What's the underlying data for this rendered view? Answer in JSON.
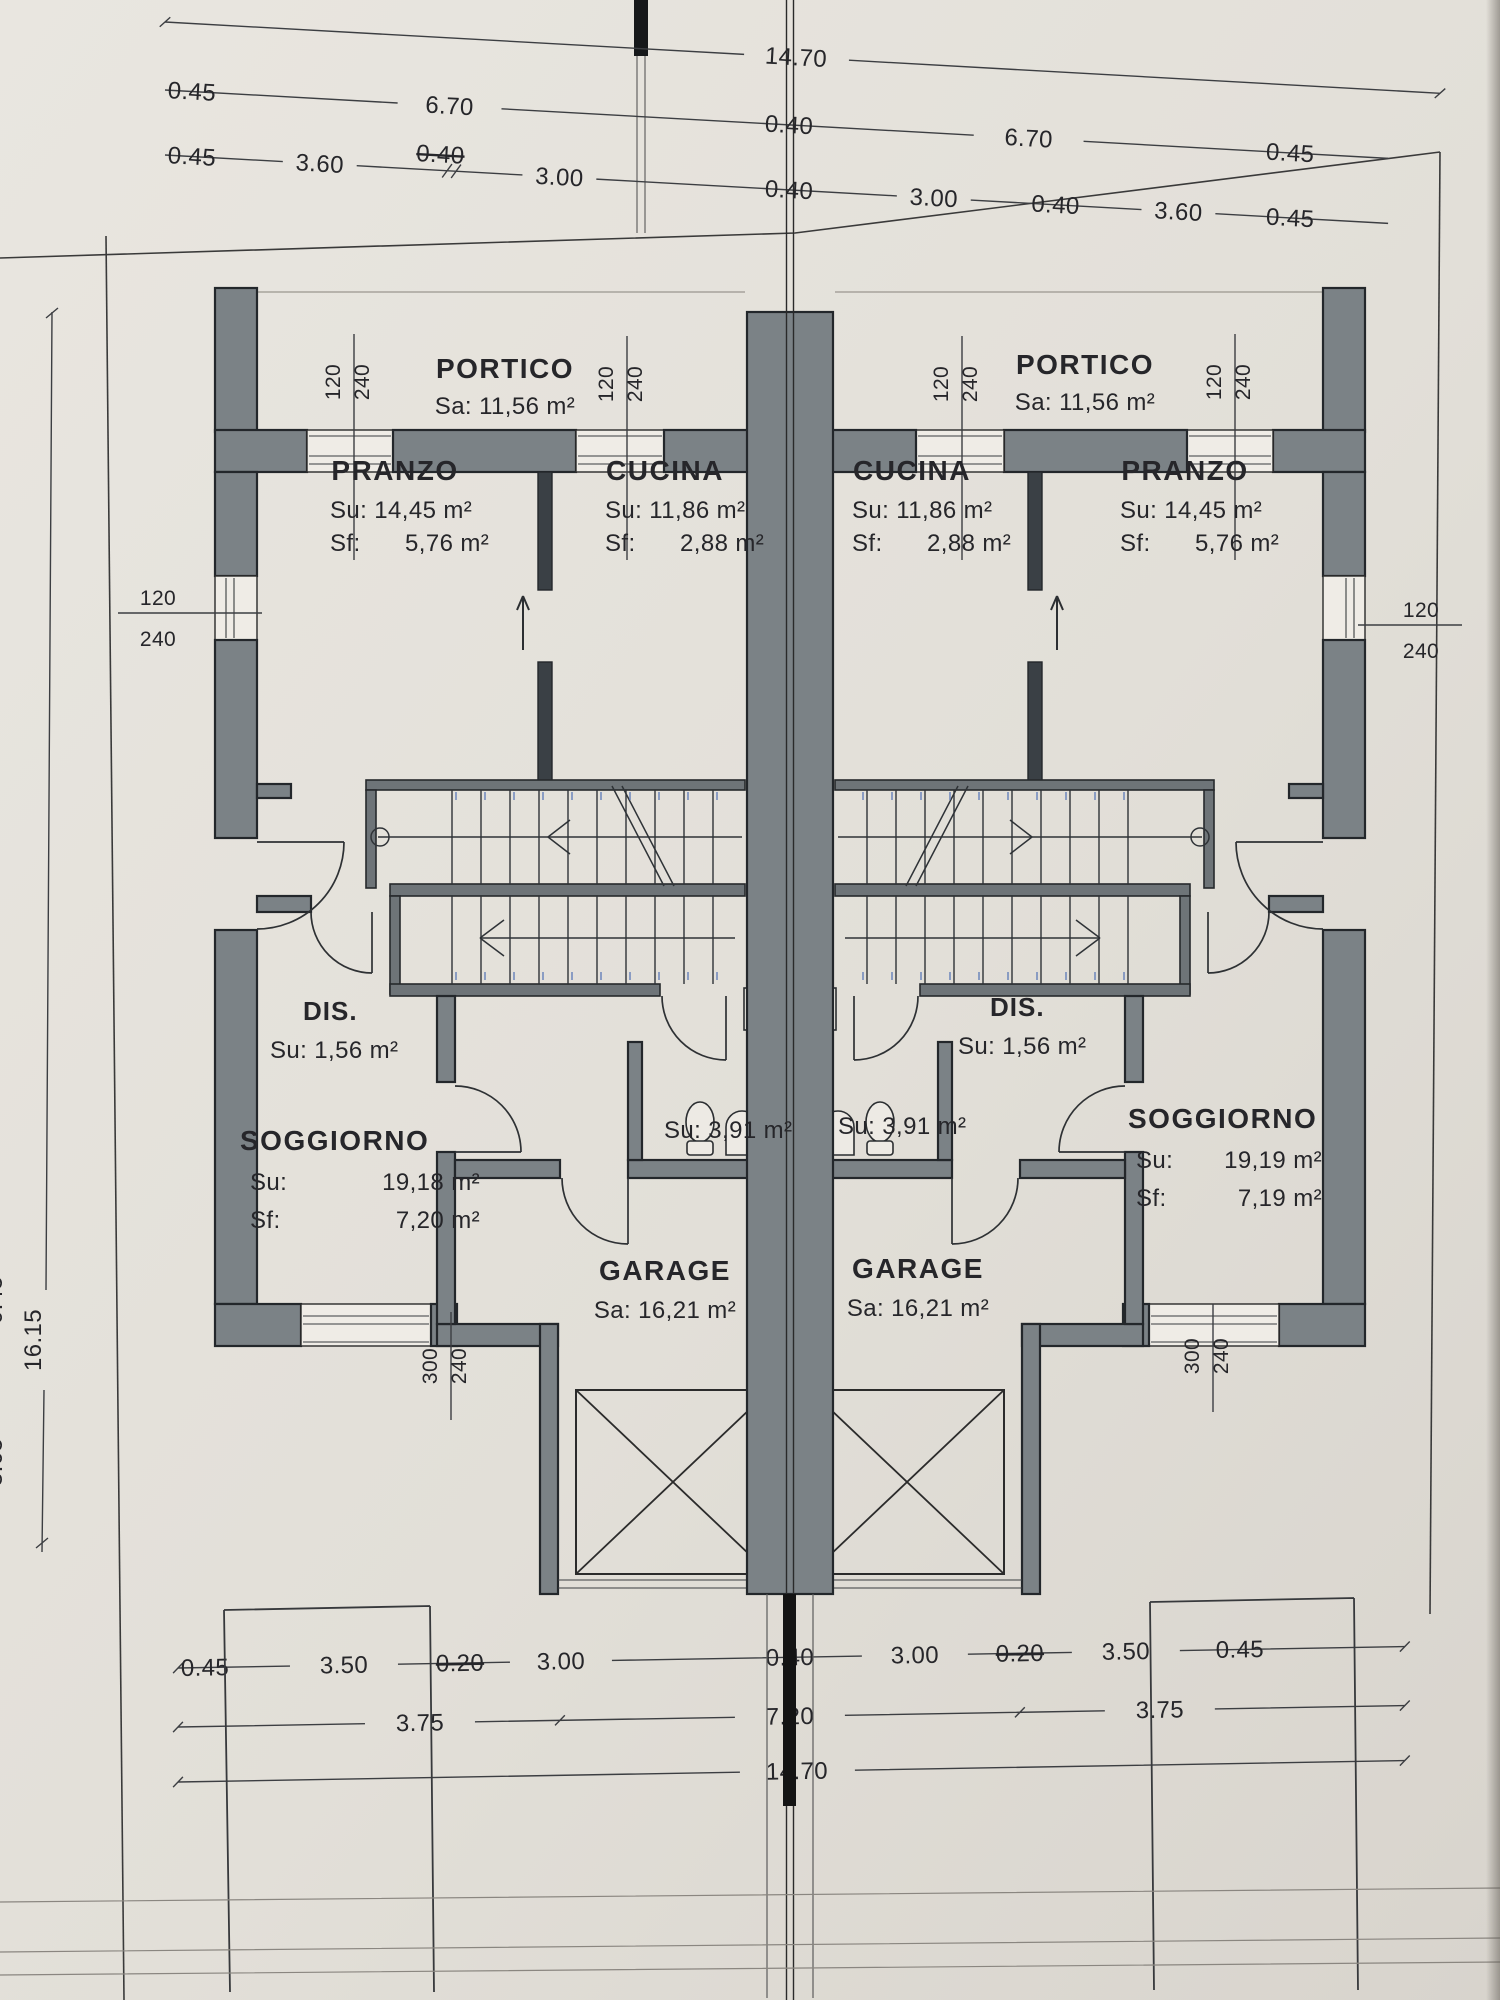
{
  "dims": {
    "top_total": "14.70",
    "top_row2": [
      "0.45",
      "6.70",
      "0.40",
      "6.70",
      "0.45"
    ],
    "top_row3": [
      "0.45",
      "3.60",
      "0.40",
      "3.00",
      "0.40",
      "3.00",
      "0.40",
      "3.60",
      "0.45"
    ],
    "bottom_row1": [
      "0.45",
      "3.50",
      "0.20",
      "3.00",
      "0.40",
      "3.00",
      "0.20",
      "3.50",
      "0.45"
    ],
    "bottom_row2": [
      "3.75",
      "7.20",
      "3.75"
    ],
    "bottom_total": "14.70",
    "side_height": "16.15",
    "side_partial": [
      "0.45",
      "3.65"
    ]
  },
  "windows": {
    "w120": "120",
    "w240": "240",
    "w300": "300"
  },
  "rooms": {
    "portico": {
      "name": "PORTICO",
      "sa": "Sa: 11,56 m²"
    },
    "pranzo": {
      "name": "PRANZO",
      "su": "Su: 14,45 m²",
      "sf_label": "Sf:",
      "sf": "5,76 m²"
    },
    "cucina": {
      "name": "CUCINA",
      "su": "Su: 11,86 m²",
      "sf_label": "Sf:",
      "sf": "2,88 m²"
    },
    "dis": {
      "name": "DIS.",
      "su": "Su: 1,56 m²"
    },
    "bagno": {
      "su": "Su: 3,91 m²"
    },
    "soggiorno_left": {
      "name": "SOGGIORNO",
      "su_label": "Su:",
      "su": "19,18 m²",
      "sf_label": "Sf:",
      "sf": "7,20 m²"
    },
    "soggiorno_right": {
      "name": "SOGGIORNO",
      "su_label": "Su:",
      "su": "19,19 m²",
      "sf_label": "Sf:",
      "sf": "7,19 m²"
    },
    "garage": {
      "name": "GARAGE",
      "sa": "Sa: 16,21 m²"
    }
  }
}
